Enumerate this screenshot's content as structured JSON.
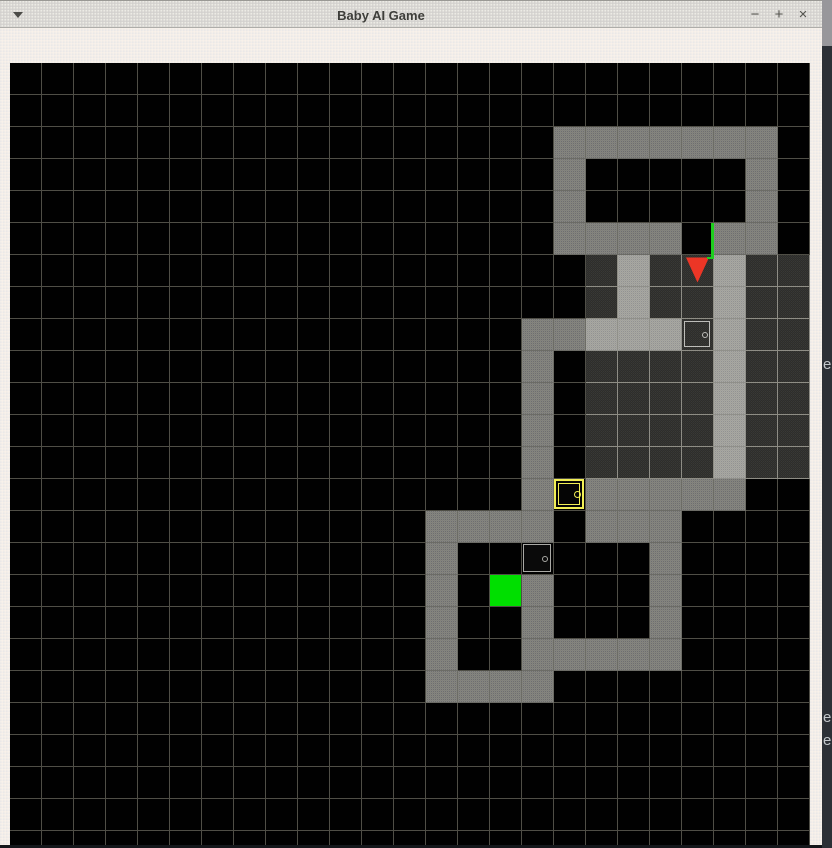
{
  "window": {
    "title": "Baby AI Game",
    "titlebar": {
      "menu_icon": "window-menu-arrow",
      "minimize_label": "−",
      "maximize_label": "+",
      "close_label": "×"
    }
  },
  "background_text": {
    "note": "letters of an occluded window visible at right edge",
    "items": [
      "e",
      "e",
      "e"
    ],
    "tops": [
      357,
      710,
      733
    ]
  },
  "grid": {
    "cols": 25,
    "rows_count": 25,
    "cell_px": 32,
    "legend": {
      ".": "floor",
      "h": "visible-floor",
      "#": "wall",
      "%": "visible-wall",
      "A": "agent",
      "G": "goal",
      "y": "yellow-locked-door",
      "d": "grey-closed-door",
      "D": "grey-closed-door-visible",
      "o": "green-open-door"
    },
    "rows": [
      ".........................",
      ".........................",
      ".................#######.",
      ".................#.....#.",
      ".................#.....#.",
      ".................####o##.",
      "..................h%hA%hh",
      "..................h%hh%hh",
      "................##%%%D%hh",
      "................#.hhhh%hh",
      "................#.hhhh%hh",
      "................#.hhhh%hh",
      "................#.hhhh%hh",
      "................#y#####..",
      ".............####.###....",
      ".............#..d...#....",
      ".............#.G#...#....",
      ".............#..#...#....",
      ".............#..#####....",
      ".............####........",
      ".........................",
      ".........................",
      ".........................",
      ".........................",
      "........................."
    ],
    "agent": {
      "cell": [
        21,
        6
      ],
      "direction": "down",
      "color": "#ec3626"
    },
    "goal": {
      "cell": [
        15,
        16
      ],
      "color": "#00df00"
    },
    "doors": [
      {
        "cell": [
          21,
          5
        ],
        "color": "#1dcf1d",
        "state": "open",
        "drawn_as": "vertical line on right edge"
      },
      {
        "cell": [
          21,
          8
        ],
        "color": "#bdbdb9",
        "state": "closed",
        "in_view": true
      },
      {
        "cell": [
          17,
          13
        ],
        "color": "#f2ef55",
        "state": "locked",
        "in_view": false
      },
      {
        "cell": [
          16,
          15
        ],
        "color": "#a9a9a5",
        "state": "closed",
        "in_view": false
      }
    ],
    "colors": {
      "floor": "#010101",
      "visible_floor": "#2e2e2a",
      "wall": "#848482",
      "visible_wall": "#a7a7a4",
      "grid_line": "#4f4e46",
      "visible_grid_line": "#8e8d85",
      "titlebar": "#d8d6d1",
      "frame": "#f2efe9",
      "behind_window": "#2c3036"
    }
  }
}
